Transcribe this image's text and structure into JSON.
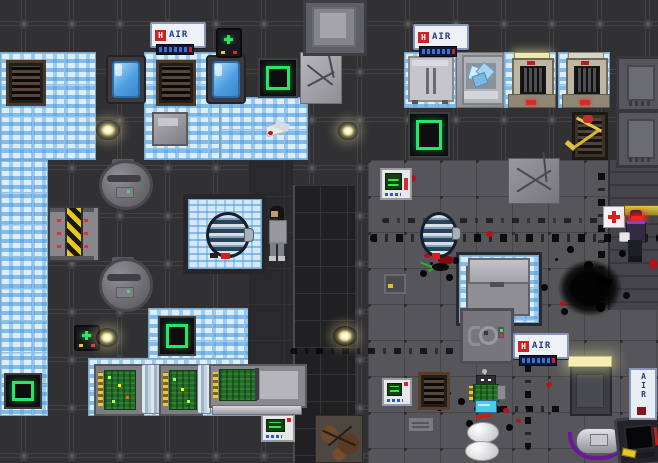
{
  "title": "space-station-game-scene",
  "canvas": {
    "width": 658,
    "height": 463
  },
  "signs": {
    "air": "AIR",
    "air_badge": "H"
  },
  "colors": {
    "circuit_tile_blue": "#5aa7e0",
    "teleporter_green": "#22e868",
    "hazard_yellow": "#e8c820",
    "pcb_green": "#1f6d22",
    "blood_red": "#b3121a",
    "flare_glow": "#fff3b0",
    "sign_text_blue": "#25368f",
    "sign_badge_red": "#cc2222",
    "hostile_eye_red": "#ff2020"
  },
  "entities": {
    "fixtures": [
      "air-sign",
      "air-alarm-bar",
      "air-alarm-device",
      "wall-terminal",
      "teleporter-pad",
      "wall-locker",
      "vent-grille",
      "blast-door",
      "first-aid-sign",
      "vault-door",
      "wall-strip"
    ],
    "machines": [
      "sleeper-pod",
      "cryo-chamber",
      "fridge",
      "ice-machine",
      "server-rack",
      "glass-pillar",
      "mainframe",
      "gravity-sphere",
      "round-tank",
      "robot-frame",
      "tall-lit-machine",
      "dark-console"
    ],
    "characters": [
      "crew-member-gray",
      "hostile-red-eyes"
    ],
    "items": [
      "metal-crate",
      "gray-box",
      "duffel-bag",
      "white-egg",
      "light-flare",
      "white-debris",
      "wire-spool",
      "yellow-tool"
    ],
    "decals": [
      "scorch-trail",
      "blood-splatter",
      "explosion-mark",
      "cracked-tile",
      "rusty-tile"
    ]
  }
}
